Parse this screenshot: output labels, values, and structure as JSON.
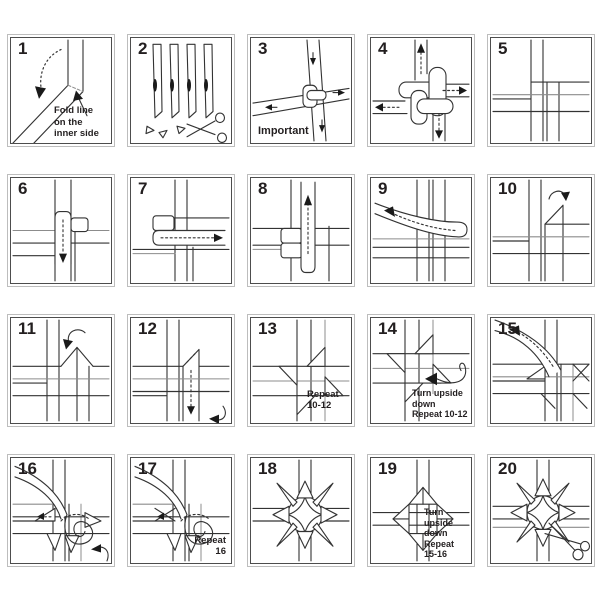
{
  "panels": [
    {
      "number": "1",
      "caption": "Fold line\non the\ninner side"
    },
    {
      "number": "2",
      "caption": ""
    },
    {
      "number": "3",
      "caption": "Important"
    },
    {
      "number": "4",
      "caption": ""
    },
    {
      "number": "5",
      "caption": ""
    },
    {
      "number": "6",
      "caption": ""
    },
    {
      "number": "7",
      "caption": ""
    },
    {
      "number": "8",
      "caption": ""
    },
    {
      "number": "9",
      "caption": ""
    },
    {
      "number": "10",
      "caption": ""
    },
    {
      "number": "11",
      "caption": ""
    },
    {
      "number": "12",
      "caption": ""
    },
    {
      "number": "13",
      "caption": "Repeat\n10-12"
    },
    {
      "number": "14",
      "caption": "Turn upside\ndown\nRepeat 10-12"
    },
    {
      "number": "15",
      "caption": ""
    },
    {
      "number": "16",
      "caption": ""
    },
    {
      "number": "17",
      "caption": "Repeat\n16"
    },
    {
      "number": "18",
      "caption": ""
    },
    {
      "number": "19",
      "caption": "Turn upside\ndown\nRepeat\n15-16"
    },
    {
      "number": "20",
      "caption": ""
    }
  ],
  "icons": {
    "scissors": "cut here",
    "rotate_arrow": "rotate / turn",
    "dashed_arrow": "pull direction",
    "line_color": "#333333",
    "frame_outer": "#bdbdbd",
    "frame_inner": "#4d4d4d"
  }
}
